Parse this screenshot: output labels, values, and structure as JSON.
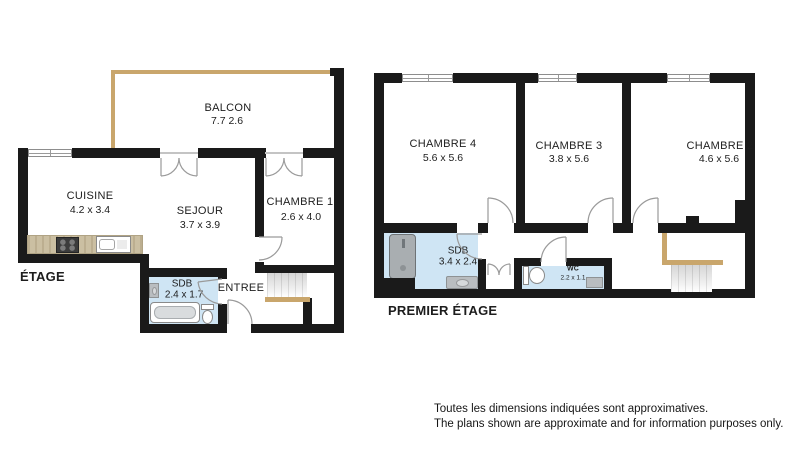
{
  "etage": {
    "title": "ÉTAGE",
    "rooms": {
      "balcon": {
        "name": "BALCON",
        "dims": "7.7 2.6"
      },
      "cuisine": {
        "name": "CUISINE",
        "dims": "4.2 x 3.4"
      },
      "sejour": {
        "name": "SEJOUR",
        "dims": "3.7 x 3.9"
      },
      "chambre1": {
        "name": "CHAMBRE 1",
        "dims": "2.6 x 4.0"
      },
      "sdb": {
        "name": "SDB",
        "dims": "2.4 x 1.7"
      },
      "entree": {
        "name": "ENTREE"
      }
    }
  },
  "premier": {
    "title": "PREMIER ÉTAGE",
    "rooms": {
      "chambre4": {
        "name": "CHAMBRE 4",
        "dims": "5.6 x 5.6"
      },
      "chambre3": {
        "name": "CHAMBRE 3",
        "dims": "3.8 x 5.6"
      },
      "chambre2": {
        "name": "CHAMBRE 2",
        "dims": "4.6 x 5.6"
      },
      "sdb": {
        "name": "SDB",
        "dims": "3.4 x 2.4"
      },
      "wc": {
        "name": "WC",
        "dims": "2.2 x 1.1"
      }
    }
  },
  "footer": {
    "line1": "Toutes les dimensions indiquées sont approximatives.",
    "line2": "The plans shown are approximate and for information purposes only."
  },
  "colors": {
    "wall": "#1a1a1a",
    "wood_accent": "#c9a66c",
    "wet_room_blue": "#cfe5f4",
    "fixture_grey": "#a9aeb1"
  }
}
